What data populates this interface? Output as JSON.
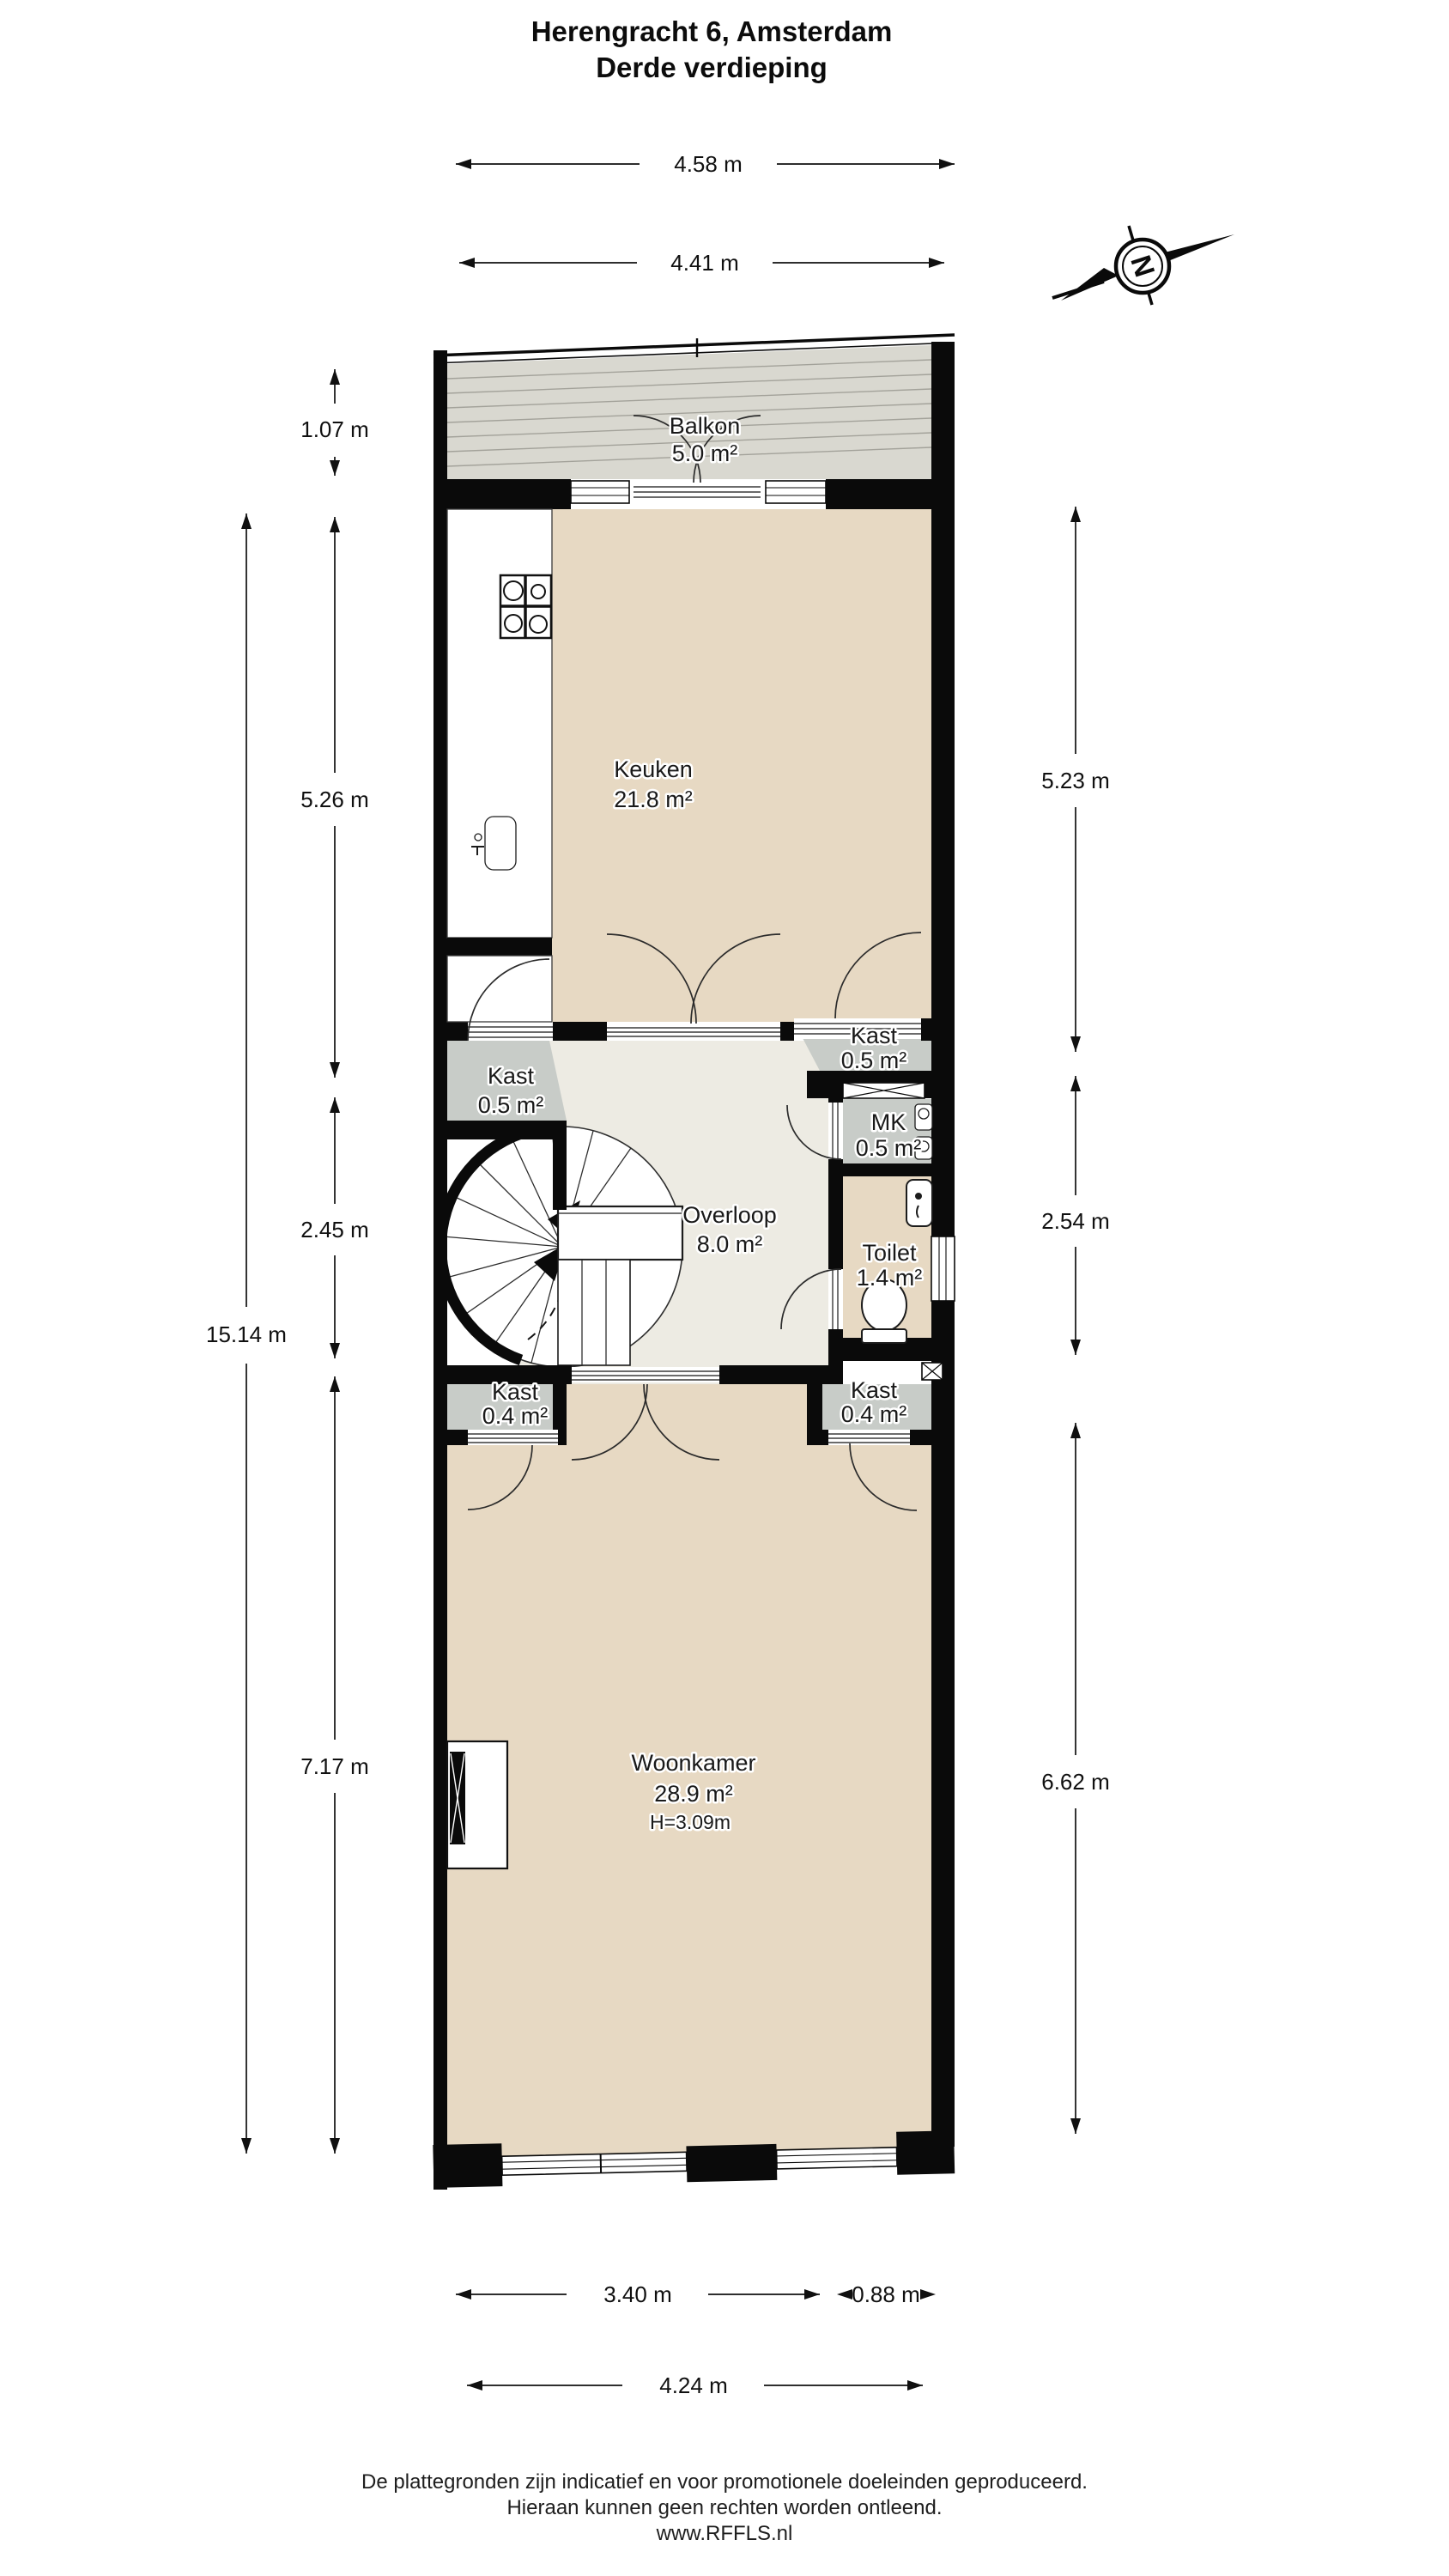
{
  "title": {
    "line1": "Herengracht 6, Amsterdam",
    "line2": "Derde verdieping"
  },
  "compass": {
    "north_letter": "N"
  },
  "rooms": {
    "balkon": {
      "name": "Balkon",
      "area": "5.0 m²"
    },
    "keuken": {
      "name": "Keuken",
      "area": "21.8 m²"
    },
    "kast_top_left": {
      "name": "Kast",
      "area": "0.5 m²"
    },
    "kast_top_right": {
      "name": "Kast",
      "area": "0.5 m²"
    },
    "mk": {
      "name": "MK",
      "area": "0.5 m²"
    },
    "overloop": {
      "name": "Overloop",
      "area": "8.0 m²"
    },
    "toilet": {
      "name": "Toilet",
      "area": "1.4 m²"
    },
    "kast_bottom_left": {
      "name": "Kast",
      "area": "0.4 m²"
    },
    "kast_bottom_right": {
      "name": "Kast",
      "area": "0.4 m²"
    },
    "woonkamer": {
      "name": "Woonkamer",
      "area": "28.9 m²",
      "ceiling_height": "H=3.09m"
    }
  },
  "dimensions": {
    "top_width_outer": "4.58 m",
    "top_width_inner": "4.41 m",
    "left_total_height": "15.14 m",
    "balkon_depth": "1.07 m",
    "keuken_height_left": "5.26 m",
    "overloop_height_left": "2.45 m",
    "woonkamer_height_left": "7.17 m",
    "keuken_height_right": "5.23 m",
    "middle_height_right": "2.54 m",
    "woonkamer_height_right": "6.62 m",
    "bottom_window_width": "3.40 m",
    "bottom_pier_width": "0.88 m",
    "bottom_width_total": "4.24 m"
  },
  "footer": {
    "line1": "De plattegronden zijn indicatief en voor promotionele doeleinden geproduceerd.",
    "line2": "Hieraan kunnen geen rechten worden ontleend.",
    "line3": "www.RFFLS.nl"
  },
  "colors": {
    "wall": "#0a0a0a",
    "floor_living": "#e7d9c3",
    "floor_cabinet": "#c8ccc8",
    "floor_balcony": "#d9d8d0",
    "floor_hall": "#edebe3",
    "fixture_white": "#ffffff",
    "dimension_text": "#101010"
  },
  "icons": {
    "compass-north-icon": "circle with N and NE arrow",
    "stove-icon": "4-burner hob grid",
    "sink-icon": "rounded basin with tap",
    "toilet-icon": "bowl with cistern",
    "hand-basin-icon": "small corner basin",
    "spiral-staircase-icon": "radial treads with walk line",
    "fireplace-icon": "chimney breast",
    "electric-meter-icon": "meter boxes",
    "shaft-icon": "crossed box"
  }
}
